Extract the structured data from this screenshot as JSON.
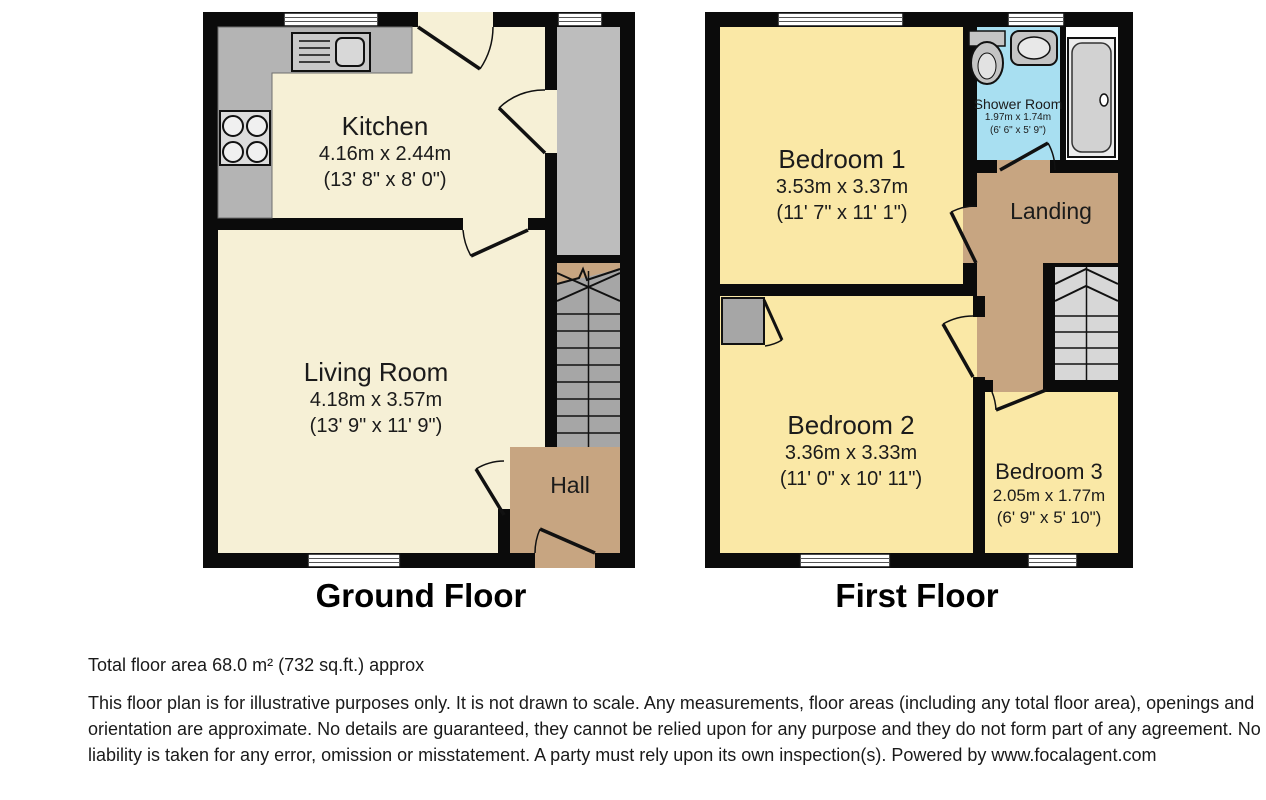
{
  "ground_floor": {
    "title": "Ground Floor",
    "rooms": {
      "kitchen": {
        "name": "Kitchen",
        "metric": "4.16m x 2.44m",
        "imperial": "(13' 8\" x 8' 0\")"
      },
      "living_room": {
        "name": "Living Room",
        "metric": "4.18m x 3.57m",
        "imperial": "(13' 9\" x 11' 9\")"
      },
      "hall": {
        "name": "Hall"
      }
    }
  },
  "first_floor": {
    "title": "First Floor",
    "rooms": {
      "bedroom_1": {
        "name": "Bedroom 1",
        "metric": "3.53m x 3.37m",
        "imperial": "(11' 7\" x 11' 1\")"
      },
      "shower_room": {
        "name": "Shower Room",
        "metric": "1.97m x 1.74m",
        "imperial": "(6' 6\" x 5' 9\")"
      },
      "landing": {
        "name": "Landing"
      },
      "bedroom_2": {
        "name": "Bedroom 2",
        "metric": "3.36m x 3.33m",
        "imperial": "(11' 0\" x 10' 11\")"
      },
      "bedroom_3": {
        "name": "Bedroom 3",
        "metric": "2.05m x 1.77m",
        "imperial": "(6' 9\" x 5' 10\")"
      }
    }
  },
  "footer": {
    "total_area": "Total floor area 68.0 m² (732 sq.ft.) approx",
    "disclaimer": "This floor plan is for illustrative purposes only. It is not drawn to scale. Any measurements, floor areas (including any total floor area), openings and orientation are approximate. No details are guaranteed, they cannot be relied upon for any purpose and they do not form part of any agreement. No liability is taken for any error, omission or misstatement. A party must rely upon its own inspection(s). Powered by www.focalagent.com"
  },
  "colors": {
    "wall": "#0b0b0b",
    "ground_room": "#f6f0d6",
    "first_room": "#fae8a6",
    "hall_landing": "#c7a581",
    "shower_room": "#a8dff1",
    "stairs_ground": "#a6a6a6",
    "stairs_first": "#d7d7d7",
    "counter_grey": "#b4b4b4",
    "store_grey": "#bdbdbd",
    "cupboard_grey": "#a6a6a6",
    "bath_white": "#ffffff"
  }
}
